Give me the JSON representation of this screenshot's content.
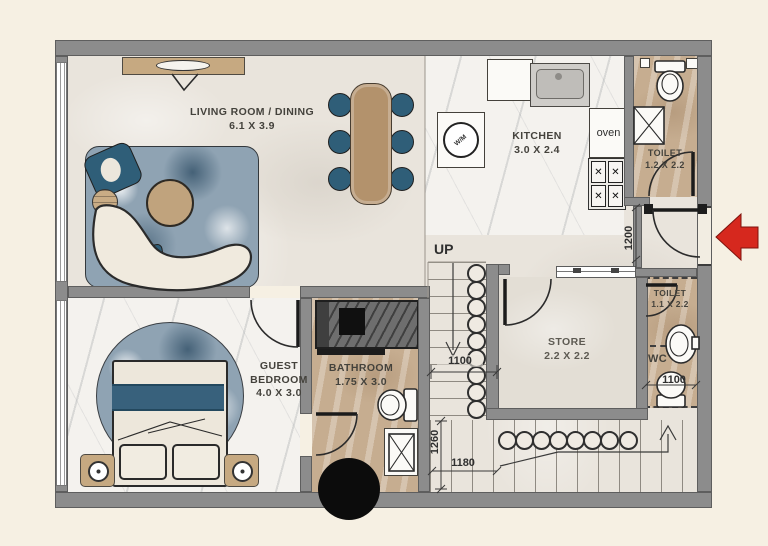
{
  "colors": {
    "wall_gray": "#8c8c8c",
    "entry_arrow_red": "#d6281e",
    "furniture_blue": "#2f5e78",
    "wood_tan": "#c6a981",
    "floor_tan": "#c6ad90"
  },
  "rooms": {
    "living": {
      "name": "LIVING ROOM / DINING",
      "dims": "6.1 X 3.9"
    },
    "kitchen": {
      "name": "KITCHEN",
      "dims": "3.0 X 2.4"
    },
    "toilet_top": {
      "name": "TOILET",
      "dims": "1.2 X 2.2"
    },
    "bedroom": {
      "name": "GUEST BEDROOM",
      "dims": "4.0 X 3.0"
    },
    "bathroom": {
      "name": "BATHROOM",
      "dims": "1.75 X 3.0"
    },
    "store": {
      "name": "STORE",
      "dims": "2.2 X 2.2"
    },
    "toilet_bottom": {
      "name": "TOILET",
      "dims": "1.1 X 2.2"
    }
  },
  "labels": {
    "up": "UP",
    "wc": "WC",
    "oven": "oven",
    "washing_machine": "W/M"
  },
  "dimensions": {
    "entry_door": "1200",
    "stair_mid": "1100",
    "stair_run": "1260",
    "stair_bottom": "1180",
    "wc_width": "1100"
  }
}
